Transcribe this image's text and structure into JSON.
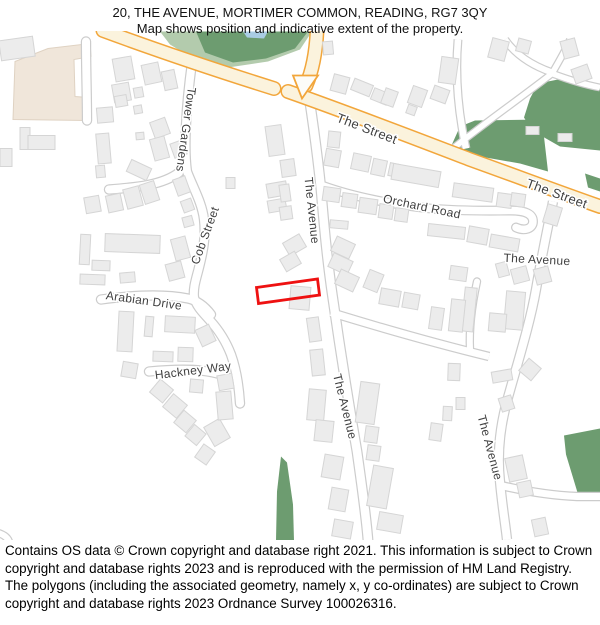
{
  "header": {
    "title_line1": "20, THE AVENUE, MORTIMER COMMON, READING, RG7 3QY",
    "title_line2": "Map shows position and indicative extent of the property."
  },
  "map": {
    "labels": {
      "street1": "The Street",
      "street2": "The Street",
      "tower_gardens": "Tower Gardens",
      "cob_street": "Cob Street",
      "orchard_road": "Orchard Road",
      "arabian_drive": "Arabian Drive",
      "hackney_way": "Hackney Way",
      "avenue_w": "The Avenue",
      "avenue_c": "The Avenue",
      "avenue_e_h": "The Avenue",
      "avenue_e_v": "The Avenue"
    },
    "colors": {
      "road_major_fill": "#FBF3DD",
      "road_major_casing": "#F2A63B",
      "road_minor_casing": "#CCCCCC",
      "road_minor_fill": "#FFFFFF",
      "green_dark": "#6D9C70",
      "green_light": "#B3CBAD",
      "water_blue": "#A9CCE3",
      "landuse_beige": "#F0E6DA",
      "building_fill": "#ECECEC",
      "building_stroke": "#D5D5D5",
      "property_outline_red": "#EE1111",
      "label_color": "#404040"
    }
  },
  "footer": {
    "copyright": "Contains OS data © Crown copyright and database right 2021. This information is subject to Crown copyright and database rights 2023 and is reproduced with the permission of HM Land Registry. The polygons (including the associated geometry, namely x, y co-ordinates) are subject to Crown copyright and database rights 2023 Ordnance Survey 100026316."
  }
}
